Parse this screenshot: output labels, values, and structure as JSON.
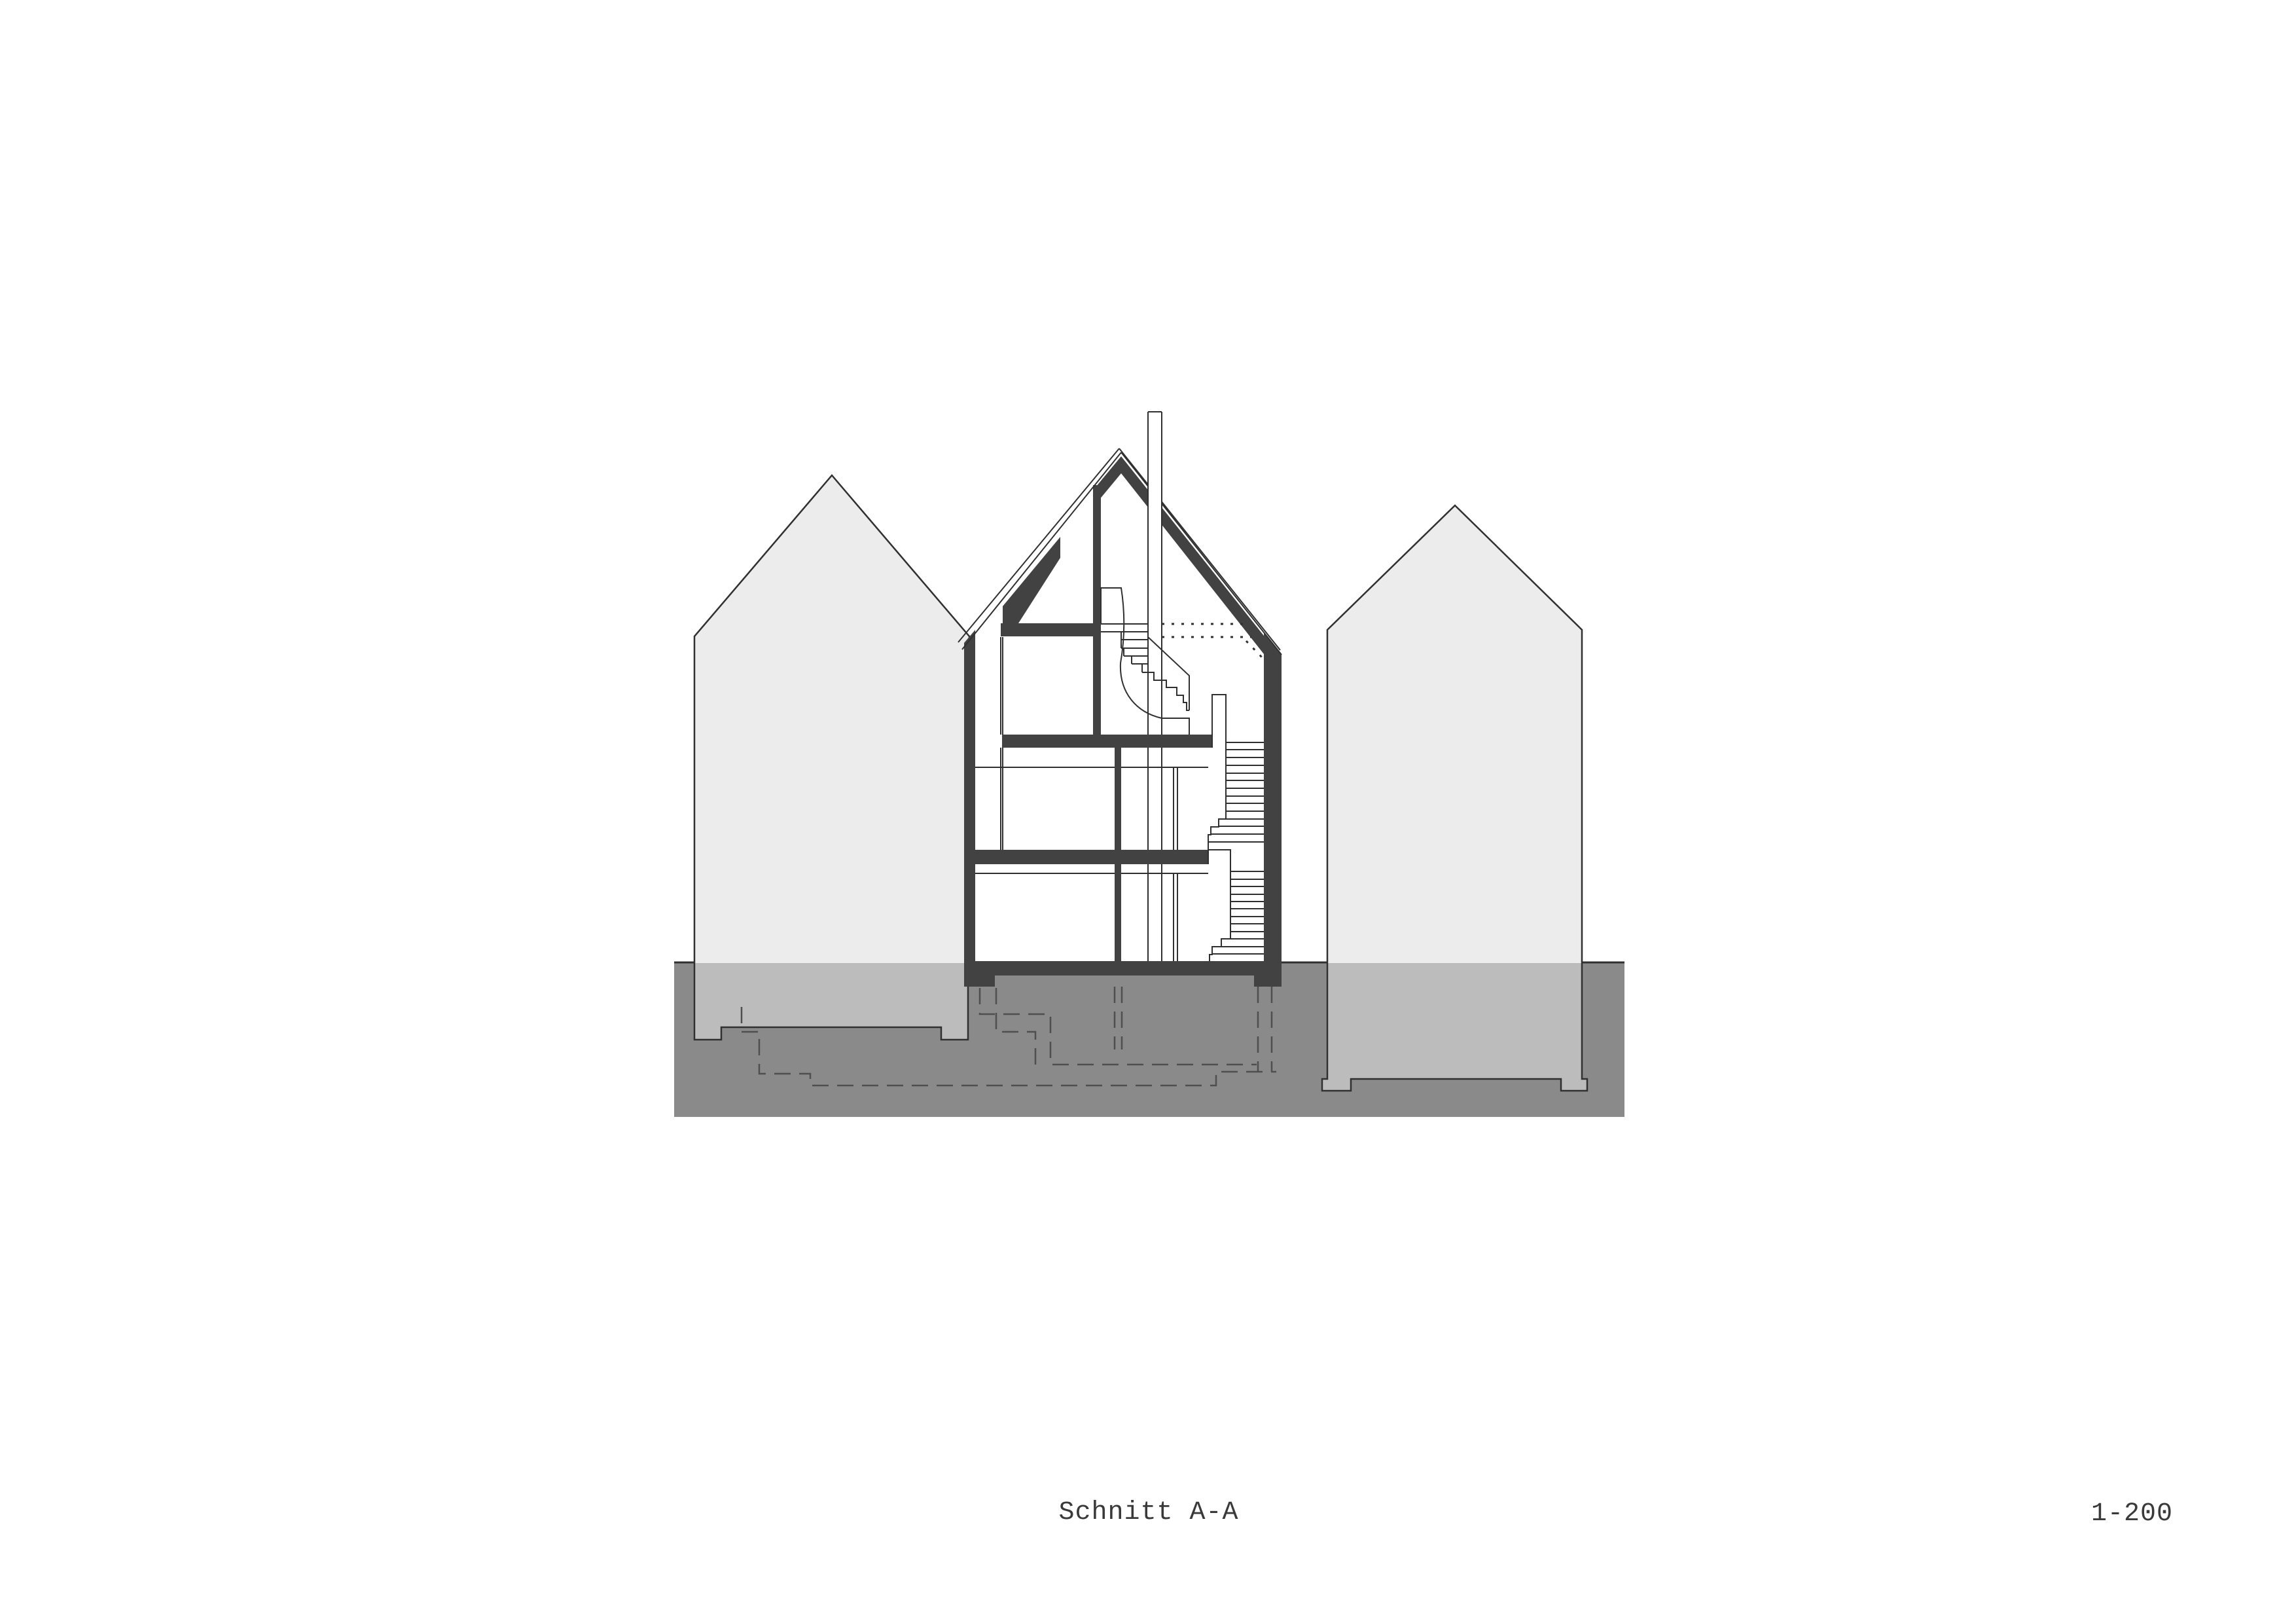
{
  "drawing": {
    "title": "Schnitt A-A",
    "scale": "1-200",
    "kind": "architectural cross-section with neighboring building silhouettes, ground mass and dashed basement excavation outline"
  },
  "colors": {
    "background": "#ffffff",
    "structure_dark": "#424242",
    "ground": "#8a8a8a",
    "neighbor_above": "#ececec",
    "neighbor_below": "#bcbcbc",
    "line": "#303030",
    "dashed_line": "#4f4f4f",
    "text": "#3a3a3a"
  }
}
